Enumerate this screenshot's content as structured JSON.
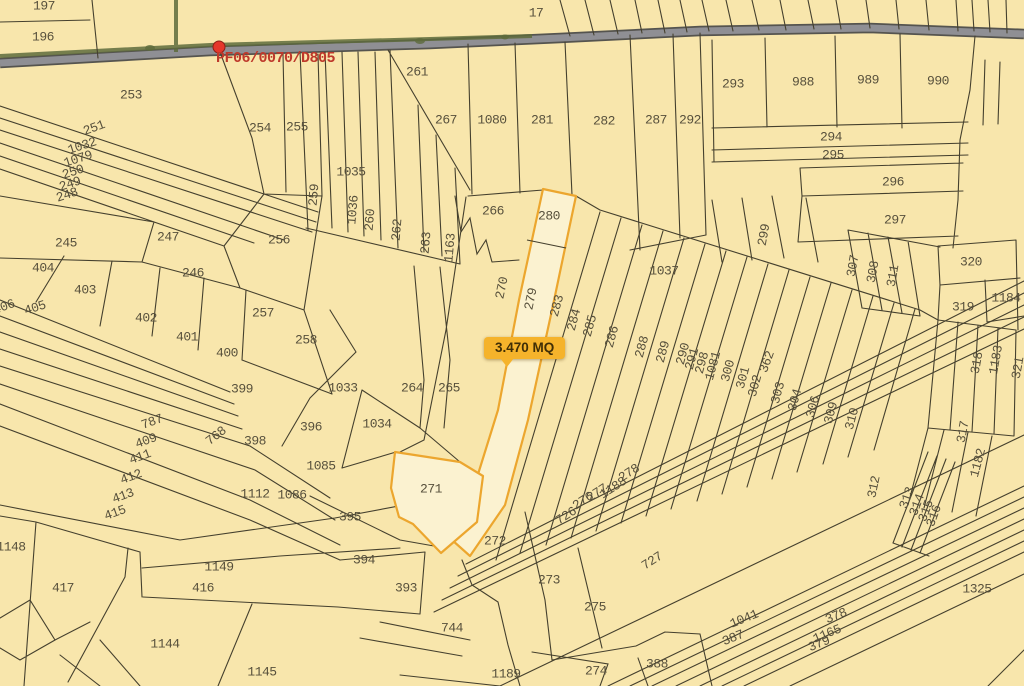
{
  "map": {
    "background_color": "#F8E6AC",
    "boundary_color": "#45402E",
    "road_color": "#8F8F94",
    "vegetation_color": "#5E6B3C",
    "label_color": "#57503C"
  },
  "marker": {
    "label": "PF06/0070/D805",
    "color": "#BE392B",
    "dot_color": "#E5372B",
    "x": 219,
    "y": 47
  },
  "badge": {
    "text": "3.470 MQ",
    "background": "#F5B32B",
    "text_color": "#3F2E06"
  },
  "highlight": {
    "fill": "#FBF2D0",
    "border": "#ECA62E",
    "parcels": [
      "280",
      "279",
      "271"
    ]
  },
  "labels": [
    {
      "t": "197",
      "x": 44,
      "y": 6,
      "r": 0
    },
    {
      "t": "196",
      "x": 43,
      "y": 37,
      "r": 0
    },
    {
      "t": "17",
      "x": 536,
      "y": 13,
      "r": 0
    },
    {
      "t": "253",
      "x": 131,
      "y": 95,
      "r": 0
    },
    {
      "t": "254",
      "x": 260,
      "y": 128,
      "r": 0
    },
    {
      "t": "255",
      "x": 297,
      "y": 127,
      "r": 0
    },
    {
      "t": "251",
      "x": 94,
      "y": 128,
      "r": -20
    },
    {
      "t": "1032",
      "x": 82,
      "y": 146,
      "r": -18
    },
    {
      "t": "1079",
      "x": 78,
      "y": 159,
      "r": -18
    },
    {
      "t": "250",
      "x": 73,
      "y": 172,
      "r": -18
    },
    {
      "t": "249",
      "x": 70,
      "y": 184,
      "r": -18
    },
    {
      "t": "248",
      "x": 67,
      "y": 195,
      "r": -18
    },
    {
      "t": "261",
      "x": 417,
      "y": 72,
      "r": 0
    },
    {
      "t": "1035",
      "x": 351,
      "y": 172,
      "r": 0
    },
    {
      "t": "259",
      "x": 314,
      "y": 195,
      "r": -85
    },
    {
      "t": "1036",
      "x": 353,
      "y": 210,
      "r": -85
    },
    {
      "t": "260",
      "x": 370,
      "y": 220,
      "r": -85
    },
    {
      "t": "262",
      "x": 397,
      "y": 230,
      "r": -85
    },
    {
      "t": "263",
      "x": 426,
      "y": 243,
      "r": -85
    },
    {
      "t": "1163",
      "x": 450,
      "y": 248,
      "r": -85
    },
    {
      "t": "267",
      "x": 446,
      "y": 120,
      "r": 0
    },
    {
      "t": "1080",
      "x": 492,
      "y": 120,
      "r": 0
    },
    {
      "t": "281",
      "x": 542,
      "y": 120,
      "r": 0
    },
    {
      "t": "282",
      "x": 604,
      "y": 121,
      "r": 0
    },
    {
      "t": "287",
      "x": 656,
      "y": 120,
      "r": 0
    },
    {
      "t": "292",
      "x": 690,
      "y": 120,
      "r": 0
    },
    {
      "t": "293",
      "x": 733,
      "y": 84,
      "r": 0
    },
    {
      "t": "988",
      "x": 803,
      "y": 82,
      "r": 0
    },
    {
      "t": "989",
      "x": 868,
      "y": 80,
      "r": 0
    },
    {
      "t": "990",
      "x": 938,
      "y": 81,
      "r": 0
    },
    {
      "t": "294",
      "x": 831,
      "y": 137,
      "r": 0
    },
    {
      "t": "295",
      "x": 833,
      "y": 155,
      "r": 0
    },
    {
      "t": "296",
      "x": 893,
      "y": 182,
      "r": 0
    },
    {
      "t": "297",
      "x": 895,
      "y": 220,
      "r": 0
    },
    {
      "t": "245",
      "x": 66,
      "y": 243,
      "r": 0
    },
    {
      "t": "247",
      "x": 168,
      "y": 237,
      "r": 0
    },
    {
      "t": "246",
      "x": 193,
      "y": 273,
      "r": 0
    },
    {
      "t": "256",
      "x": 279,
      "y": 240,
      "r": 0
    },
    {
      "t": "404",
      "x": 43,
      "y": 268,
      "r": 0
    },
    {
      "t": "403",
      "x": 85,
      "y": 290,
      "r": 0
    },
    {
      "t": "402",
      "x": 146,
      "y": 318,
      "r": 0
    },
    {
      "t": "401",
      "x": 187,
      "y": 337,
      "r": 0
    },
    {
      "t": "400",
      "x": 227,
      "y": 353,
      "r": 0
    },
    {
      "t": "406",
      "x": 4,
      "y": 307,
      "r": -20
    },
    {
      "t": "405",
      "x": 35,
      "y": 308,
      "r": -18
    },
    {
      "t": "257",
      "x": 263,
      "y": 313,
      "r": 0
    },
    {
      "t": "258",
      "x": 306,
      "y": 340,
      "r": 0
    },
    {
      "t": "399",
      "x": 242,
      "y": 389,
      "r": 0
    },
    {
      "t": "396",
      "x": 311,
      "y": 427,
      "r": 0
    },
    {
      "t": "398",
      "x": 255,
      "y": 441,
      "r": 0
    },
    {
      "t": "768",
      "x": 216,
      "y": 436,
      "r": -38
    },
    {
      "t": "787",
      "x": 152,
      "y": 422,
      "r": -20
    },
    {
      "t": "409",
      "x": 146,
      "y": 441,
      "r": -20
    },
    {
      "t": "411",
      "x": 140,
      "y": 457,
      "r": -20
    },
    {
      "t": "412",
      "x": 131,
      "y": 477,
      "r": -20
    },
    {
      "t": "413",
      "x": 123,
      "y": 496,
      "r": -20
    },
    {
      "t": "415",
      "x": 115,
      "y": 513,
      "r": -20
    },
    {
      "t": "1112",
      "x": 255,
      "y": 494,
      "r": 0
    },
    {
      "t": "1086",
      "x": 292,
      "y": 495,
      "r": 0
    },
    {
      "t": "1085",
      "x": 321,
      "y": 466,
      "r": 0
    },
    {
      "t": "1033",
      "x": 343,
      "y": 388,
      "r": 0
    },
    {
      "t": "1034",
      "x": 377,
      "y": 424,
      "r": 0
    },
    {
      "t": "264",
      "x": 412,
      "y": 388,
      "r": 0
    },
    {
      "t": "265",
      "x": 449,
      "y": 388,
      "r": 0
    },
    {
      "t": "266",
      "x": 493,
      "y": 211,
      "r": 0
    },
    {
      "t": "280",
      "x": 549,
      "y": 216,
      "r": 0
    },
    {
      "t": "270",
      "x": 502,
      "y": 288,
      "r": -78
    },
    {
      "t": "279",
      "x": 531,
      "y": 299,
      "r": -78
    },
    {
      "t": "283",
      "x": 557,
      "y": 306,
      "r": -75
    },
    {
      "t": "284",
      "x": 574,
      "y": 320,
      "r": -75
    },
    {
      "t": "285",
      "x": 590,
      "y": 326,
      "r": -75
    },
    {
      "t": "286",
      "x": 612,
      "y": 337,
      "r": -75
    },
    {
      "t": "288",
      "x": 642,
      "y": 347,
      "r": -75
    },
    {
      "t": "289",
      "x": 663,
      "y": 352,
      "r": -75
    },
    {
      "t": "290",
      "x": 683,
      "y": 354,
      "r": -75
    },
    {
      "t": "291",
      "x": 692,
      "y": 359,
      "r": -75
    },
    {
      "t": "298",
      "x": 702,
      "y": 363,
      "r": -75
    },
    {
      "t": "1081",
      "x": 713,
      "y": 366,
      "r": -75
    },
    {
      "t": "300",
      "x": 728,
      "y": 371,
      "r": -75
    },
    {
      "t": "301",
      "x": 743,
      "y": 378,
      "r": -75
    },
    {
      "t": "302",
      "x": 755,
      "y": 386,
      "r": -75
    },
    {
      "t": "362",
      "x": 767,
      "y": 362,
      "r": -70
    },
    {
      "t": "303",
      "x": 778,
      "y": 393,
      "r": -75
    },
    {
      "t": "304",
      "x": 795,
      "y": 400,
      "r": -75
    },
    {
      "t": "306",
      "x": 813,
      "y": 407,
      "r": -75
    },
    {
      "t": "309",
      "x": 831,
      "y": 413,
      "r": -75
    },
    {
      "t": "310",
      "x": 852,
      "y": 419,
      "r": -75
    },
    {
      "t": "299",
      "x": 764,
      "y": 235,
      "r": -80
    },
    {
      "t": "1037",
      "x": 664,
      "y": 271,
      "r": 0
    },
    {
      "t": "307",
      "x": 853,
      "y": 266,
      "r": -80
    },
    {
      "t": "308",
      "x": 873,
      "y": 272,
      "r": -80
    },
    {
      "t": "311",
      "x": 893,
      "y": 276,
      "r": -80
    },
    {
      "t": "320",
      "x": 971,
      "y": 262,
      "r": 0
    },
    {
      "t": "319",
      "x": 963,
      "y": 307,
      "r": 0
    },
    {
      "t": "1184",
      "x": 1006,
      "y": 298,
      "r": 0
    },
    {
      "t": "1183",
      "x": 996,
      "y": 360,
      "r": -80
    },
    {
      "t": "321",
      "x": 1018,
      "y": 368,
      "r": -80
    },
    {
      "t": "318",
      "x": 977,
      "y": 363,
      "r": -80
    },
    {
      "t": "317",
      "x": 963,
      "y": 432,
      "r": -80
    },
    {
      "t": "1182",
      "x": 978,
      "y": 463,
      "r": -75
    },
    {
      "t": "312",
      "x": 874,
      "y": 487,
      "r": -78
    },
    {
      "t": "313",
      "x": 907,
      "y": 498,
      "r": -70
    },
    {
      "t": "314",
      "x": 917,
      "y": 505,
      "r": -70
    },
    {
      "t": "315",
      "x": 926,
      "y": 511,
      "r": -70
    },
    {
      "t": "316",
      "x": 934,
      "y": 516,
      "r": -70
    },
    {
      "t": "271",
      "x": 431,
      "y": 489,
      "r": 0
    },
    {
      "t": "272",
      "x": 495,
      "y": 541,
      "r": 0
    },
    {
      "t": "273",
      "x": 549,
      "y": 580,
      "r": 0
    },
    {
      "t": "275",
      "x": 595,
      "y": 607,
      "r": 0
    },
    {
      "t": "274",
      "x": 596,
      "y": 671,
      "r": 0
    },
    {
      "t": "388",
      "x": 657,
      "y": 664,
      "r": 0
    },
    {
      "t": "393",
      "x": 406,
      "y": 588,
      "r": 0
    },
    {
      "t": "744",
      "x": 452,
      "y": 628,
      "r": 0
    },
    {
      "t": "1189",
      "x": 506,
      "y": 674,
      "r": 0
    },
    {
      "t": "394",
      "x": 364,
      "y": 560,
      "r": 0
    },
    {
      "t": "395",
      "x": 350,
      "y": 517,
      "r": 0
    },
    {
      "t": "726",
      "x": 566,
      "y": 516,
      "r": -33
    },
    {
      "t": "276",
      "x": 583,
      "y": 501,
      "r": -33
    },
    {
      "t": "277",
      "x": 597,
      "y": 493,
      "r": -33
    },
    {
      "t": "1188",
      "x": 613,
      "y": 488,
      "r": -33
    },
    {
      "t": "278",
      "x": 629,
      "y": 473,
      "r": -33
    },
    {
      "t": "727",
      "x": 652,
      "y": 561,
      "r": -33
    },
    {
      "t": "1041",
      "x": 744,
      "y": 619,
      "r": -22
    },
    {
      "t": "387",
      "x": 733,
      "y": 638,
      "r": -22
    },
    {
      "t": "378",
      "x": 836,
      "y": 616,
      "r": -22
    },
    {
      "t": "1165",
      "x": 827,
      "y": 634,
      "r": -22
    },
    {
      "t": "379",
      "x": 819,
      "y": 644,
      "r": -22
    },
    {
      "t": "1325",
      "x": 977,
      "y": 589,
      "r": 0
    },
    {
      "t": "1148",
      "x": 11,
      "y": 547,
      "r": 0
    },
    {
      "t": "417",
      "x": 63,
      "y": 588,
      "r": 0
    },
    {
      "t": "1149",
      "x": 219,
      "y": 567,
      "r": 0
    },
    {
      "t": "416",
      "x": 203,
      "y": 588,
      "r": 0
    },
    {
      "t": "1144",
      "x": 165,
      "y": 644,
      "r": 0
    },
    {
      "t": "1145",
      "x": 262,
      "y": 672,
      "r": 0
    }
  ]
}
